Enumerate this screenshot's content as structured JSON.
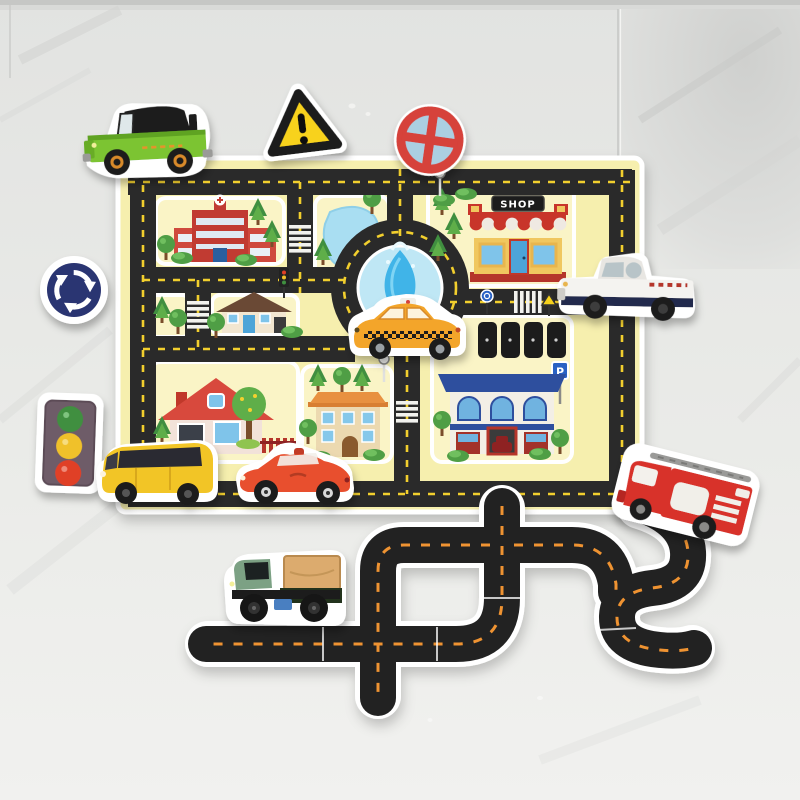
{
  "scene": {
    "caption": "Foam bath-toy road play mat with vehicle and traffic-sign stickers on a glossy marble tile wall",
    "labels": {
      "shop_sign": "SHOP",
      "parking_sign": "P"
    },
    "colors": {
      "tile_wall": "#eaebe8",
      "tile_seam": "#c7c8c6",
      "mat_background": "#f6efae",
      "block_background": "#faf4c6",
      "road_black": "#2b2b2b",
      "mat_road_dash_yellow": "#f2cf2d",
      "track_road_dash_orange": "#ef9330",
      "foam_border_white": "#ffffff",
      "jeep_green": "#7cc431",
      "pickup_white": "#f4f3f0",
      "pickup_stripe_navy": "#232a4d",
      "taxi_orange": "#f3a52a",
      "minibus_yellow": "#f2c527",
      "convertible_red": "#e8502f",
      "fire_truck_red": "#d8302a",
      "cargo_truck_green": "#7ba184",
      "cargo_box_tan": "#dcab6e",
      "warning_sign_yellow": "#f8d21f",
      "crossing_sign_red": "#d6423a",
      "crossing_sign_blue": "#abcfe2",
      "roundabout_sign_navy": "#2c3472",
      "traffic_light_body": "#6e5b67",
      "traffic_light_green": "#3f8f3f",
      "traffic_light_yellow": "#f0c12b",
      "traffic_light_red": "#e04028",
      "pond_blue": "#a9def2",
      "fountain_blue": "#3fb4e8",
      "hospital_red": "#c13a30",
      "shop_wall_yellow": "#f0c75e",
      "shop_awning_red": "#c8342c",
      "house_roof_red": "#d84a3c",
      "apartment_orange": "#e89140",
      "garage_roof_blue": "#2f4f9e",
      "parking_sign_blue": "#2b62c4"
    },
    "stickers": [
      {
        "name": "green-jeep",
        "kind": "vehicle"
      },
      {
        "name": "warning-triangle-sign",
        "kind": "traffic-sign"
      },
      {
        "name": "crossroads-circle-sign",
        "kind": "traffic-sign"
      },
      {
        "name": "roundabout-sign",
        "kind": "traffic-sign"
      },
      {
        "name": "white-pickup-truck",
        "kind": "vehicle"
      },
      {
        "name": "yellow-taxi",
        "kind": "vehicle"
      },
      {
        "name": "traffic-light",
        "kind": "traffic-sign"
      },
      {
        "name": "yellow-minibus",
        "kind": "vehicle"
      },
      {
        "name": "red-convertible",
        "kind": "vehicle"
      },
      {
        "name": "fire-truck",
        "kind": "vehicle"
      },
      {
        "name": "green-cargo-truck",
        "kind": "vehicle"
      }
    ],
    "map_features": [
      "hospital-building",
      "pond",
      "shop-building",
      "roundabout-fountain",
      "parking-lot",
      "small-house",
      "red-roof-house",
      "apartment-building",
      "garage-building",
      "crosswalks",
      "trees",
      "street-lamps",
      "mini-traffic-lights"
    ],
    "track_pieces": [
      "straight",
      "curve",
      "t-junction",
      "cross-junction",
      "s-curve"
    ]
  }
}
